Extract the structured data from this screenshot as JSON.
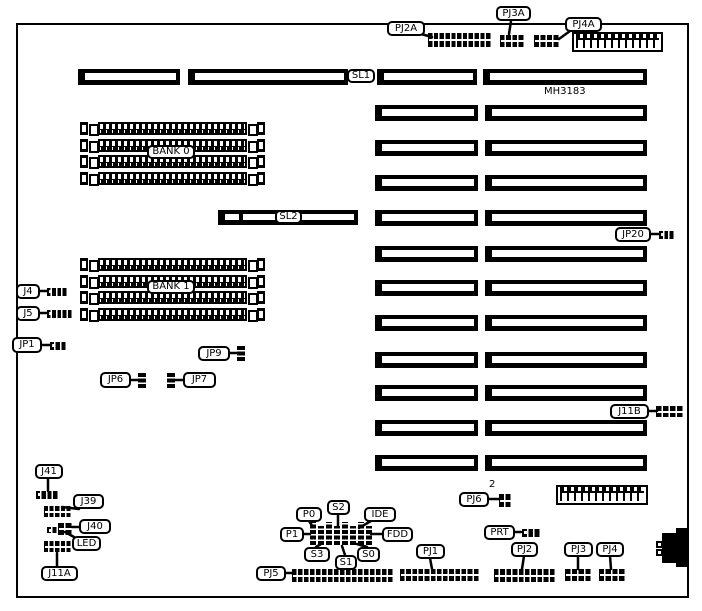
{
  "diagram": {
    "part_number": "MH3183",
    "colors": {
      "fg": "#000000",
      "bg": "#ffffff"
    },
    "board": {
      "x": 16,
      "y": 23,
      "w": 673,
      "h": 575
    },
    "labels": [
      {
        "id": "pj2a",
        "text": "PJ2A",
        "x": 387,
        "y": 21,
        "w": 38,
        "h": 15
      },
      {
        "id": "pj3a",
        "text": "PJ3A",
        "x": 496,
        "y": 6,
        "w": 35,
        "h": 15
      },
      {
        "id": "pj4a",
        "text": "PJ4A",
        "x": 565,
        "y": 17,
        "w": 37,
        "h": 15
      },
      {
        "id": "sl1",
        "text": "SL1",
        "x": 347,
        "y": 69,
        "w": 28,
        "h": 14
      },
      {
        "id": "mh3183",
        "text": "MH3183",
        "x": 544,
        "y": 86,
        "w": 46,
        "h": 12,
        "plain": true
      },
      {
        "id": "bank0",
        "text": "BANK 0",
        "x": 147,
        "y": 145,
        "w": 48,
        "h": 14
      },
      {
        "id": "sl2",
        "text": "SL2",
        "x": 275,
        "y": 210,
        "w": 27,
        "h": 14
      },
      {
        "id": "jp20",
        "text": "JP20",
        "x": 615,
        "y": 227,
        "w": 36,
        "h": 15
      },
      {
        "id": "j4",
        "text": "J4",
        "x": 16,
        "y": 284,
        "w": 24,
        "h": 15
      },
      {
        "id": "j5",
        "text": "J5",
        "x": 16,
        "y": 306,
        "w": 24,
        "h": 15
      },
      {
        "id": "bank1",
        "text": "BANK 1",
        "x": 147,
        "y": 280,
        "w": 48,
        "h": 14
      },
      {
        "id": "jp1",
        "text": "JP1",
        "x": 12,
        "y": 337,
        "w": 30,
        "h": 16
      },
      {
        "id": "jp9",
        "text": "JP9",
        "x": 198,
        "y": 346,
        "w": 32,
        "h": 15
      },
      {
        "id": "jp6",
        "text": "JP6",
        "x": 100,
        "y": 372,
        "w": 31,
        "h": 16
      },
      {
        "id": "jp7",
        "text": "JP7",
        "x": 183,
        "y": 372,
        "w": 33,
        "h": 16
      },
      {
        "id": "j11b",
        "text": "J11B",
        "x": 610,
        "y": 404,
        "w": 39,
        "h": 15
      },
      {
        "id": "j41",
        "text": "J41",
        "x": 35,
        "y": 464,
        "w": 28,
        "h": 15
      },
      {
        "id": "j39",
        "text": "J39",
        "x": 73,
        "y": 494,
        "w": 31,
        "h": 15
      },
      {
        "id": "j40",
        "text": "J40",
        "x": 79,
        "y": 519,
        "w": 32,
        "h": 15
      },
      {
        "id": "led",
        "text": "LED",
        "x": 72,
        "y": 536,
        "w": 29,
        "h": 15
      },
      {
        "id": "j11a",
        "text": "J11A",
        "x": 41,
        "y": 566,
        "w": 37,
        "h": 15
      },
      {
        "id": "pj6",
        "text": "PJ6",
        "x": 459,
        "y": 492,
        "w": 30,
        "h": 15
      },
      {
        "id": "pj6-count",
        "text": "2",
        "x": 489,
        "y": 479,
        "w": 10,
        "h": 12,
        "plain": true
      },
      {
        "id": "p0",
        "text": "P0",
        "x": 296,
        "y": 507,
        "w": 26,
        "h": 15
      },
      {
        "id": "s2",
        "text": "S2",
        "x": 327,
        "y": 500,
        "w": 23,
        "h": 15
      },
      {
        "id": "ide",
        "text": "IDE",
        "x": 364,
        "y": 507,
        "w": 32,
        "h": 15
      },
      {
        "id": "p1",
        "text": "P1",
        "x": 280,
        "y": 527,
        "w": 24,
        "h": 15
      },
      {
        "id": "fdd",
        "text": "FDD",
        "x": 382,
        "y": 527,
        "w": 31,
        "h": 15
      },
      {
        "id": "s3",
        "text": "S3",
        "x": 304,
        "y": 547,
        "w": 26,
        "h": 15
      },
      {
        "id": "s1",
        "text": "S1",
        "x": 335,
        "y": 555,
        "w": 22,
        "h": 15
      },
      {
        "id": "s0",
        "text": "S0",
        "x": 357,
        "y": 547,
        "w": 23,
        "h": 15
      },
      {
        "id": "pj5",
        "text": "PJ5",
        "x": 256,
        "y": 566,
        "w": 30,
        "h": 15
      },
      {
        "id": "pj1",
        "text": "PJ1",
        "x": 416,
        "y": 544,
        "w": 29,
        "h": 15
      },
      {
        "id": "prt",
        "text": "PRT",
        "x": 484,
        "y": 525,
        "w": 31,
        "h": 15
      },
      {
        "id": "pj2",
        "text": "PJ2",
        "x": 511,
        "y": 542,
        "w": 27,
        "h": 15
      },
      {
        "id": "pj3",
        "text": "PJ3",
        "x": 564,
        "y": 542,
        "w": 29,
        "h": 15
      },
      {
        "id": "pj4",
        "text": "PJ4",
        "x": 596,
        "y": 542,
        "w": 28,
        "h": 15
      }
    ],
    "slots": [
      {
        "x": 78,
        "y": 69,
        "w": 102,
        "h": 16
      },
      {
        "x": 188,
        "y": 69,
        "w": 160,
        "h": 16
      },
      {
        "x": 377,
        "y": 69,
        "w": 100,
        "h": 16
      },
      {
        "x": 483,
        "y": 69,
        "w": 164,
        "h": 16
      },
      {
        "x": 375,
        "y": 105,
        "w": 103,
        "h": 16
      },
      {
        "x": 485,
        "y": 105,
        "w": 162,
        "h": 16
      },
      {
        "x": 375,
        "y": 140,
        "w": 103,
        "h": 16
      },
      {
        "x": 485,
        "y": 140,
        "w": 162,
        "h": 16
      },
      {
        "x": 375,
        "y": 175,
        "w": 103,
        "h": 16
      },
      {
        "x": 485,
        "y": 175,
        "w": 162,
        "h": 16
      },
      {
        "x": 375,
        "y": 210,
        "w": 103,
        "h": 16
      },
      {
        "x": 485,
        "y": 210,
        "w": 162,
        "h": 16
      },
      {
        "x": 375,
        "y": 246,
        "w": 103,
        "h": 16
      },
      {
        "x": 485,
        "y": 246,
        "w": 162,
        "h": 16
      },
      {
        "x": 375,
        "y": 280,
        "w": 103,
        "h": 16
      },
      {
        "x": 485,
        "y": 280,
        "w": 162,
        "h": 16
      },
      {
        "x": 375,
        "y": 315,
        "w": 103,
        "h": 16
      },
      {
        "x": 485,
        "y": 315,
        "w": 162,
        "h": 16
      },
      {
        "x": 375,
        "y": 352,
        "w": 103,
        "h": 16
      },
      {
        "x": 485,
        "y": 352,
        "w": 162,
        "h": 16
      },
      {
        "x": 375,
        "y": 385,
        "w": 103,
        "h": 16
      },
      {
        "x": 485,
        "y": 385,
        "w": 162,
        "h": 16
      },
      {
        "x": 375,
        "y": 420,
        "w": 103,
        "h": 16
      },
      {
        "x": 485,
        "y": 420,
        "w": 162,
        "h": 16
      },
      {
        "x": 375,
        "y": 455,
        "w": 103,
        "h": 16
      },
      {
        "x": 485,
        "y": 455,
        "w": 162,
        "h": 16
      }
    ],
    "sl2_bar": {
      "x": 218,
      "y": 210,
      "w": 140,
      "h": 15
    },
    "banks": [
      {
        "id": "bank-0",
        "x": 80,
        "y": 122,
        "w": 185,
        "rows": 4,
        "pitch": 16.5
      },
      {
        "id": "bank-1",
        "x": 80,
        "y": 258,
        "w": 185,
        "rows": 4,
        "pitch": 16.5
      }
    ],
    "headers2": [
      {
        "id": "pj2a-connector",
        "x": 428,
        "y": 33,
        "w": 64,
        "h": 14,
        "cols": 11
      },
      {
        "id": "pj3a-connector",
        "x": 500,
        "y": 35,
        "w": 25,
        "h": 12,
        "cols": 4
      },
      {
        "id": "pj4a-connector",
        "x": 534,
        "y": 35,
        "w": 26,
        "h": 12,
        "cols": 4
      },
      {
        "id": "j39-connector",
        "x": 44,
        "y": 506,
        "w": 28,
        "h": 11,
        "cols": 5
      },
      {
        "id": "j11a-connector",
        "x": 44,
        "y": 541,
        "w": 28,
        "h": 11,
        "cols": 5
      },
      {
        "id": "j11b-connector",
        "x": 656,
        "y": 406,
        "w": 28,
        "h": 11,
        "cols": 4
      },
      {
        "id": "pj5-connector",
        "x": 292,
        "y": 569,
        "w": 102,
        "h": 13,
        "cols": 17
      },
      {
        "id": "pj1-connector",
        "x": 400,
        "y": 569,
        "w": 80,
        "h": 12,
        "cols": 13
      },
      {
        "id": "pj2-connector",
        "x": 494,
        "y": 569,
        "w": 62,
        "h": 13,
        "cols": 10
      },
      {
        "id": "pj3-connector",
        "x": 565,
        "y": 569,
        "w": 27,
        "h": 12,
        "cols": 4
      },
      {
        "id": "pj4-connector",
        "x": 599,
        "y": 569,
        "w": 27,
        "h": 12,
        "cols": 4
      },
      {
        "id": "j40-connector",
        "x": 58,
        "y": 523,
        "w": 15,
        "h": 12,
        "cols": 2
      },
      {
        "id": "pj6-connector",
        "x": 499,
        "y": 494,
        "w": 13,
        "h": 13,
        "cols": 2
      }
    ],
    "headers1": [
      {
        "id": "j4-connector",
        "x": 47,
        "y": 288,
        "w": 21,
        "h": 8,
        "cols": 4
      },
      {
        "id": "j5-connector",
        "x": 47,
        "y": 310,
        "w": 26,
        "h": 8,
        "cols": 5
      },
      {
        "id": "jp1-connector",
        "x": 50,
        "y": 342,
        "w": 17,
        "h": 8,
        "cols": 3
      },
      {
        "id": "jp20-connector",
        "x": 659,
        "y": 231,
        "w": 16,
        "h": 8,
        "cols": 3
      },
      {
        "id": "j41-connector",
        "x": 36,
        "y": 491,
        "w": 23,
        "h": 8,
        "cols": 4
      },
      {
        "id": "prt-connector",
        "x": 522,
        "y": 529,
        "w": 19,
        "h": 8,
        "cols": 3
      },
      {
        "id": "j40-aux-connector",
        "x": 47,
        "y": 527,
        "w": 11,
        "h": 6,
        "cols": 2
      }
    ],
    "vconns": [
      {
        "id": "jp9-connector",
        "x": 237,
        "y": 345,
        "w": 8,
        "h": 16
      },
      {
        "id": "jp6-connector",
        "x": 138,
        "y": 372,
        "w": 8,
        "h": 16
      },
      {
        "id": "jp7-connector",
        "x": 167,
        "y": 372,
        "w": 8,
        "h": 16
      }
    ],
    "pin_strips": {
      "x": 310,
      "pitch": 8,
      "count": 8,
      "w": 6,
      "y_tall": 522,
      "h_tall": 23,
      "y_short": 526,
      "h_short": 19
    },
    "power_connectors": [
      {
        "id": "power-connector-top",
        "x": 572,
        "y": 32,
        "w": 91,
        "h": 20
      },
      {
        "id": "power-connector-bottom",
        "x": 556,
        "y": 485,
        "w": 92,
        "h": 20
      }
    ],
    "din_connector": {
      "main": {
        "x": 662,
        "y": 533,
        "w": 27,
        "h": 30
      },
      "bump": {
        "x": 676,
        "y": 528,
        "w": 13,
        "h": 39
      },
      "pins": [
        {
          "x": 656,
          "y": 541,
          "w": 7,
          "h": 7
        },
        {
          "x": 656,
          "y": 549,
          "w": 7,
          "h": 7
        }
      ]
    },
    "callouts": [
      {
        "x1": 421,
        "y1": 34,
        "x2": 432,
        "y2": 37
      },
      {
        "x1": 511,
        "y1": 21,
        "x2": 509,
        "y2": 34
      },
      {
        "x1": 570,
        "y1": 31,
        "x2": 559,
        "y2": 39
      },
      {
        "x1": 650,
        "y1": 234,
        "x2": 660,
        "y2": 234
      },
      {
        "x1": 39,
        "y1": 291,
        "x2": 48,
        "y2": 291
      },
      {
        "x1": 39,
        "y1": 313,
        "x2": 48,
        "y2": 313
      },
      {
        "x1": 41,
        "y1": 345,
        "x2": 51,
        "y2": 345
      },
      {
        "x1": 229,
        "y1": 353,
        "x2": 238,
        "y2": 353
      },
      {
        "x1": 130,
        "y1": 380,
        "x2": 139,
        "y2": 380
      },
      {
        "x1": 183,
        "y1": 380,
        "x2": 174,
        "y2": 380
      },
      {
        "x1": 648,
        "y1": 411,
        "x2": 657,
        "y2": 411
      },
      {
        "x1": 48,
        "y1": 478,
        "x2": 48,
        "y2": 491
      },
      {
        "x1": 79,
        "y1": 509,
        "x2": 62,
        "y2": 507
      },
      {
        "x1": 80,
        "y1": 527,
        "x2": 72,
        "y2": 527
      },
      {
        "x1": 74,
        "y1": 537,
        "x2": 65,
        "y2": 532
      },
      {
        "x1": 57,
        "y1": 566,
        "x2": 57,
        "y2": 553
      },
      {
        "x1": 488,
        "y1": 499,
        "x2": 500,
        "y2": 499
      },
      {
        "x1": 309,
        "y1": 521,
        "x2": 313,
        "y2": 527
      },
      {
        "x1": 338,
        "y1": 514,
        "x2": 338,
        "y2": 526
      },
      {
        "x1": 371,
        "y1": 521,
        "x2": 359,
        "y2": 528
      },
      {
        "x1": 303,
        "y1": 534,
        "x2": 310,
        "y2": 534
      },
      {
        "x1": 383,
        "y1": 534,
        "x2": 371,
        "y2": 534
      },
      {
        "x1": 316,
        "y1": 547,
        "x2": 321,
        "y2": 544
      },
      {
        "x1": 345,
        "y1": 555,
        "x2": 342,
        "y2": 546
      },
      {
        "x1": 367,
        "y1": 547,
        "x2": 357,
        "y2": 544
      },
      {
        "x1": 285,
        "y1": 573,
        "x2": 292,
        "y2": 573
      },
      {
        "x1": 430,
        "y1": 558,
        "x2": 432,
        "y2": 569
      },
      {
        "x1": 514,
        "y1": 532,
        "x2": 521,
        "y2": 532
      },
      {
        "x1": 524,
        "y1": 556,
        "x2": 522,
        "y2": 569
      },
      {
        "x1": 578,
        "y1": 556,
        "x2": 578,
        "y2": 569
      },
      {
        "x1": 610,
        "y1": 556,
        "x2": 611,
        "y2": 569
      }
    ]
  }
}
